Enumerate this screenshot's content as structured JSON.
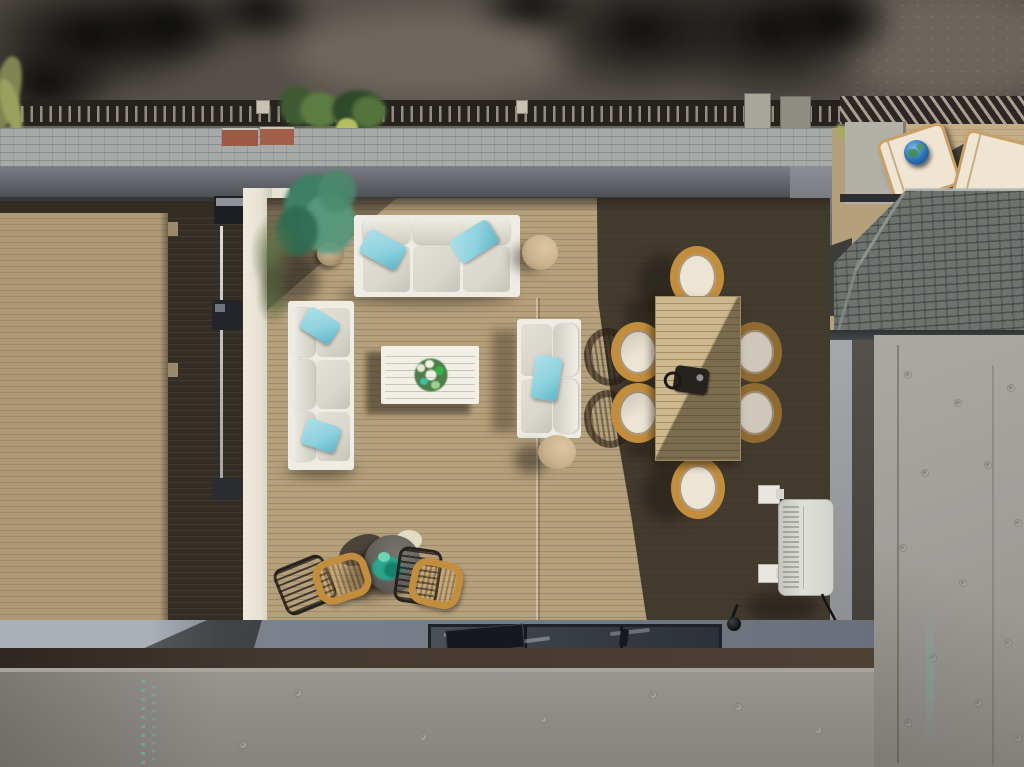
{
  "scene": {
    "type": "aerial-photograph",
    "labels": {
      "pavement": "Street pavement with tree shadows",
      "railing": "Rooftop guard railing",
      "shingle_roof": "Gray shingle roof edge",
      "rooftop_deck": "Rooftop deck with tan composite decking",
      "left_deck": "Side deck walkway",
      "sofa_top": "Three-seat outdoor sofa with teal pillows",
      "sofa_left": "Three-seat outdoor sofa with teal pillows",
      "loveseat": "Two-seat outdoor loveseat with teal pillow",
      "coffee_table": "White slatted coffee table with wreath centerpiece",
      "side_table_top": "Round drum side table",
      "side_table_bottom": "Round drum side table",
      "potted_plant": "Potted olive plant in wicker pot",
      "dining_table": "Rectangular outdoor dining table",
      "dining_chair": "Oval wicker dining chair with white cushion",
      "grill_item": "Small tabletop lantern",
      "bistro_table": "Round bistro table with plant",
      "bistro_chair": "Wicker bistro chair",
      "metal_chair": "Black metal wire chair",
      "hvac": "Wall-mounted mini-split HVAC condenser",
      "skylight": "Glass skylight",
      "concrete_wall": "Board-formed concrete wall",
      "balcony": "Neighboring balcony with sun loungers",
      "lounger": "Cushioned sun lounger",
      "globe": "Decorative world globe",
      "stamp": "Faint stamped markings on concrete"
    }
  },
  "palette": {
    "pavement": "#56504a",
    "pavement_light": "#6e675f",
    "railing_dark": "#26231f",
    "railing_slat": "#a89f92",
    "shingle_light": "#a7aaa9",
    "shingle_dark": "#6e7370",
    "brick_red": "#9c5a44",
    "fascia_dark": "#45484d",
    "deck_sunlit": "#b5a07c",
    "deck_left": "#ac9877",
    "deck_dark_strip": "#342d25",
    "deck_shadow": "#3a322a",
    "wall_white": "#e7e2d4",
    "sofa_frame": "#eeece4",
    "cushion": "#d9d6cc",
    "pillow_teal": "#8ed2de",
    "pillow_teal_deep": "#5fb4c6",
    "table_white": "#f2efe6",
    "wreath_green": "#4e7d49",
    "wreath_teal": "#3fbf9f",
    "pouf": "#c9b28d",
    "rattan": "#c28e3e",
    "chair_cushion": "#ece4d4",
    "dining_table_sun": "#cdb88d",
    "bistro_table": "#605f5b",
    "plant_teal": "#2ca58c",
    "hvac_body": "#e0e0da",
    "skylight_glass": "#3a3f46",
    "curb_gray": "#7c838e",
    "band_brown": "#443931",
    "concrete": "#908d89",
    "concrete_right": "#a29f9b",
    "stamp_teal": "#6fc4c0",
    "balcony_floor": "#c4ad87",
    "lounger_cream": "#f0e5d3",
    "globe_blue": "#2a6fb0"
  }
}
